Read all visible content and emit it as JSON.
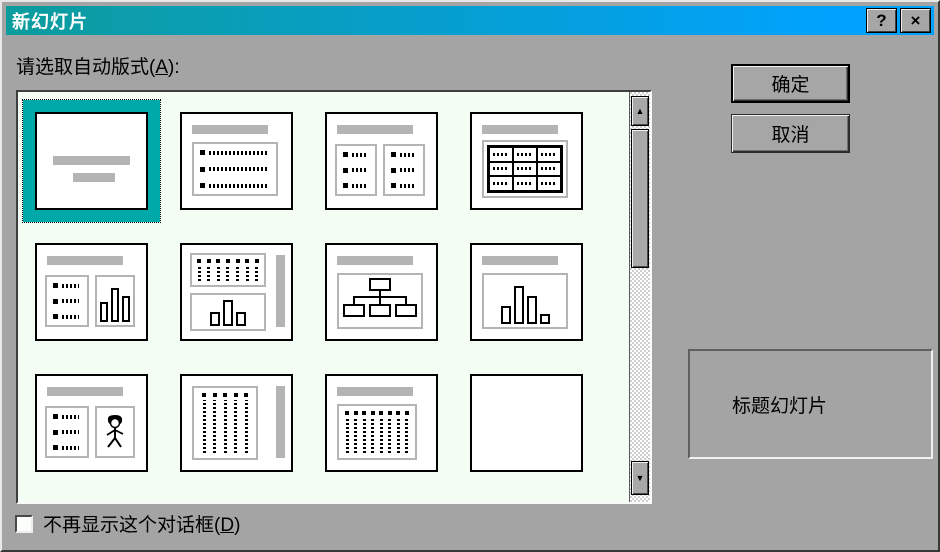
{
  "window": {
    "title": "新幻灯片",
    "help_icon": "?",
    "close_icon": "×"
  },
  "prompt": {
    "pre": "请选取自动版式(",
    "accel": "A",
    "post": "):"
  },
  "layout_grid": {
    "selected_index": 0,
    "items": [
      {
        "name": "title-slide"
      },
      {
        "name": "bulleted-list"
      },
      {
        "name": "two-column-text"
      },
      {
        "name": "table"
      },
      {
        "name": "text-and-chart"
      },
      {
        "name": "vertical-text-and-chart"
      },
      {
        "name": "organization-chart"
      },
      {
        "name": "chart"
      },
      {
        "name": "text-and-clip-art"
      },
      {
        "name": "vertical-text"
      },
      {
        "name": "title-and-vertical-text"
      },
      {
        "name": "blank"
      }
    ]
  },
  "scrollbar": {
    "up_icon": "▲",
    "down_icon": "▼"
  },
  "actions": {
    "ok": "确定",
    "cancel": "取消"
  },
  "preview": {
    "description": "标题幻灯片"
  },
  "footer_checkbox": {
    "pre": "不再显示这个对话框(",
    "accel": "D",
    "post": ")",
    "checked": false
  },
  "colors": {
    "titlebar_gradient_start": "#0d9c9c",
    "titlebar_gradient_end": "#00a2ff",
    "selection_teal": "#00a9a9",
    "list_background": "#f4fdf4",
    "dialog_background": "#a4a4a4"
  }
}
